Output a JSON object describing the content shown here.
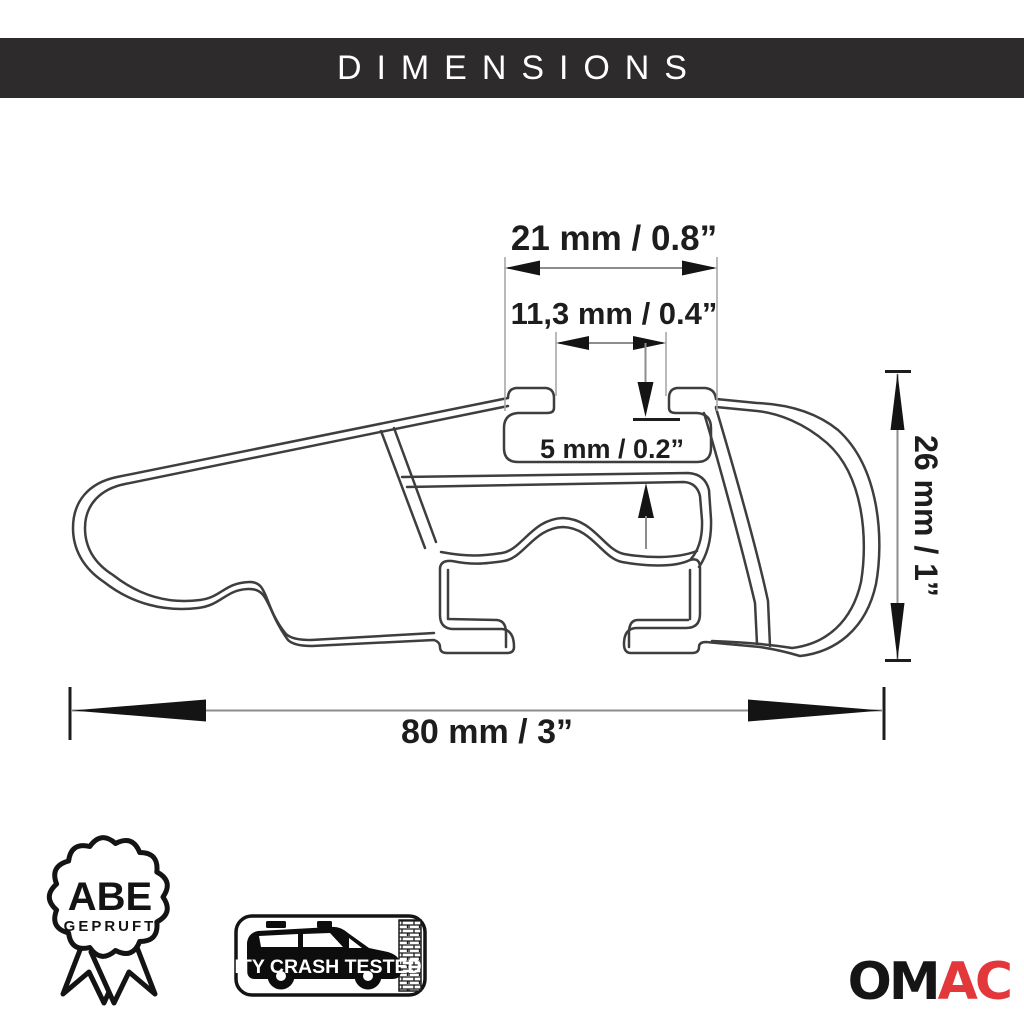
{
  "header": {
    "title": "DIMENSIONS"
  },
  "diagram": {
    "dims": {
      "top_width": "21 mm / 0.8”",
      "slot_width": "11,3 mm / 0.4”",
      "wall_thickness": "5 mm / 0.2”",
      "bar_height": "26 mm / 1”",
      "bar_width": "80 mm / 3”"
    }
  },
  "badges": {
    "abe": {
      "title": "ABE",
      "subtitle": "GEPRUFT"
    },
    "crash": {
      "label": "CITY CRASH TESTED"
    }
  },
  "brand": {
    "prefix": "OM",
    "suffix": "AC"
  },
  "colors": {
    "header_bg": "#2d2b2c",
    "header_text": "#ffffff",
    "outline": "#3e3e3e",
    "dim_line": "#8d8d8d",
    "dim_text": "#1d1d1d",
    "brand_black": "#151515",
    "brand_red": "#e2373b"
  }
}
